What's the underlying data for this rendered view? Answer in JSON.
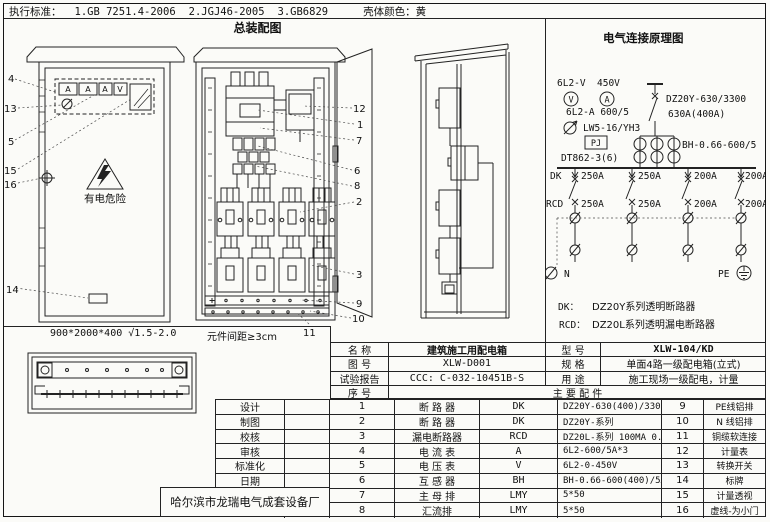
{
  "header": {
    "standards_label": "执行标准：",
    "standards": [
      "1.GB 7251.4-2006",
      "2.JGJ46-2005",
      "3.GB6829"
    ],
    "shell_color_label": "壳体颜色：黄"
  },
  "assembly": {
    "title": "总装配图",
    "front_view": {
      "callouts": [
        "4",
        "13",
        "5",
        "15",
        "16",
        "14"
      ],
      "meters": [
        "A",
        "A",
        "A",
        "V"
      ],
      "warning_text": "有电危险",
      "dimension": "900*2000*400 √1.5-2.0"
    },
    "internal_view": {
      "callouts": [
        "12",
        "1",
        "7",
        "6",
        "8",
        "2",
        "3",
        "9",
        "10"
      ],
      "callout_11": "11",
      "spacing_note": "元件间距≥3cm"
    }
  },
  "schematic": {
    "title": "电气连接原理图",
    "labels": {
      "voltmeter_model": "6L2-V",
      "voltage": "450V",
      "voltmeter": "V",
      "ammeter": "A",
      "ammeter_model": "6L2-A 600/5",
      "switch_model": "LW5-16/YH3",
      "meter_box": "PJ",
      "energy_meter": "DT862-3(6)",
      "main_breaker": "DZ20Y-630/3300",
      "main_rating": "630A(400A)",
      "ct_model": "BH-0.66-600/5",
      "dk": "DK",
      "rcd": "RCD",
      "neutral": "N",
      "pe": "PE"
    },
    "branch_breaker_ratings": [
      "250A",
      "250A",
      "200A",
      "200A"
    ],
    "branch_rcd_ratings": [
      "250A",
      "250A",
      "200A",
      "200A"
    ],
    "legend": [
      {
        "key": "DK：",
        "desc": "DZ20Y系列透明断路器"
      },
      {
        "key": "RCD：",
        "desc": "DZ20L系列透明漏电断路器"
      }
    ]
  },
  "info_table": {
    "rows": [
      {
        "l1": "名  称",
        "v1": "建筑施工用配电箱",
        "l2": "型  号",
        "v2": "XLW-104/KD"
      },
      {
        "l1": "图  号",
        "v1": "XLW-D001",
        "l2": "规  格",
        "v2": "单面4路一级配电箱(立式)"
      },
      {
        "l1": "试验报告",
        "v1": "CCC: C-032-10451B-S",
        "l2": "用  途",
        "v2": "施工现场一级配电，计量"
      }
    ],
    "seq_label": "序  号",
    "parts_label": "主 要 配 件"
  },
  "parts_table": {
    "rows": [
      {
        "sig": "设计",
        "seq": "1",
        "name": "断 路 器",
        "code": "DK",
        "spec": "DZ20Y-630(400)/3300",
        "seq2": "9",
        "name2": "PE线铝排"
      },
      {
        "sig": "制图",
        "seq": "2",
        "name": "断 路 器",
        "code": "DK",
        "spec": "DZ20Y-系列",
        "seq2": "10",
        "name2": "N 线铝排"
      },
      {
        "sig": "校核",
        "seq": "3",
        "name": "漏电断路器",
        "code": "RCD",
        "spec": "DZ20L-系列 100MA 0.2S",
        "seq2": "11",
        "name2": "铜缆软连接"
      },
      {
        "sig": "审核",
        "seq": "4",
        "name": "电 流 表",
        "code": "A",
        "spec": "6L2-600/5A*3",
        "seq2": "12",
        "name2": "计量表"
      },
      {
        "sig": "标准化",
        "seq": "5",
        "name": "电 压 表",
        "code": "V",
        "spec": "6L2-0-450V",
        "seq2": "13",
        "name2": "转换开关"
      },
      {
        "sig": "日期",
        "seq": "6",
        "name": "互 感 器",
        "code": "BH",
        "spec": "BH-0.66-600(400)/5A",
        "seq2": "14",
        "name2": "标牌"
      },
      {
        "sig": "",
        "seq": "7",
        "name": "主 母 排",
        "code": "LMY",
        "spec": "5*50",
        "seq2": "15",
        "name2": "计量透视"
      },
      {
        "sig": "",
        "seq": "8",
        "name": "汇流排",
        "code": "LMY",
        "spec": "5*50",
        "seq2": "16",
        "name2": "虚线-为小门"
      }
    ],
    "company": "哈尔滨市龙瑞电气成套设备厂"
  }
}
